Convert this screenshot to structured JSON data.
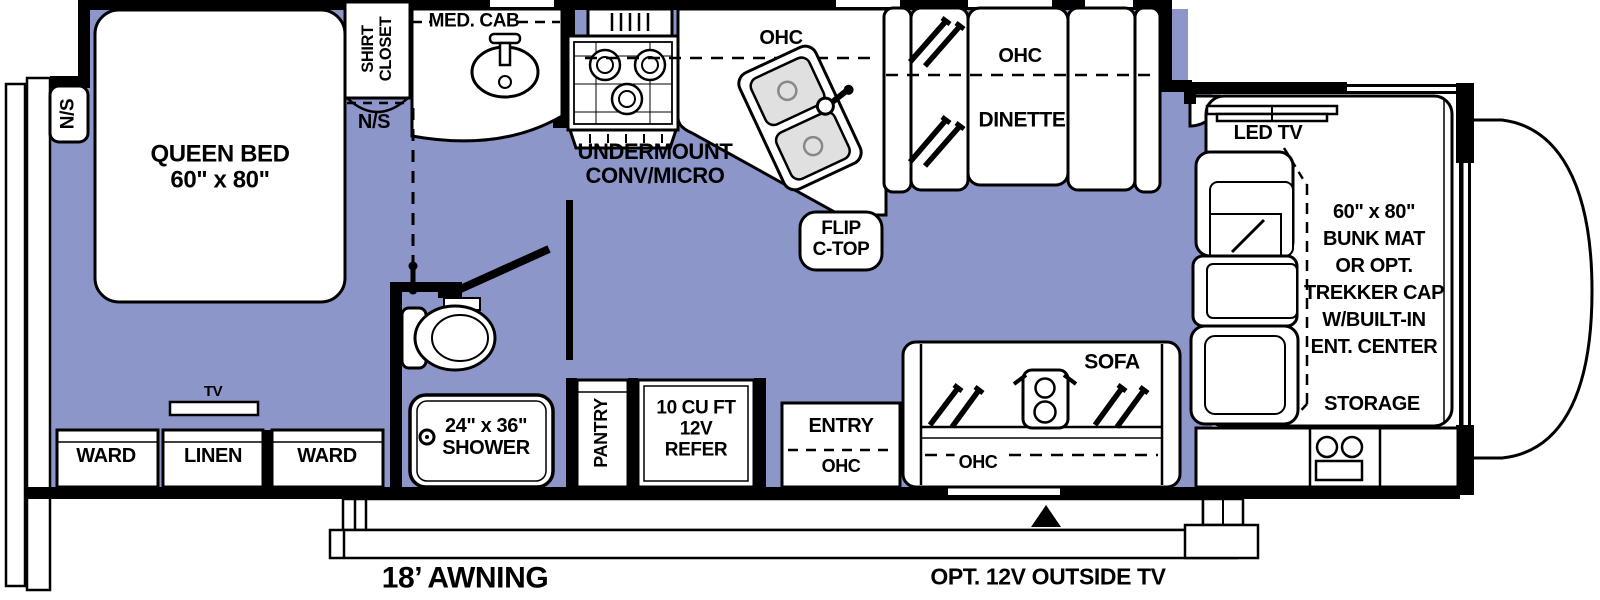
{
  "floorplan": {
    "title": "Class C motorhome floor plan",
    "bedroom": {
      "nightstand_left": "N/S",
      "bed_line1": "QUEEN BED",
      "bed_line2": "60\" x 80\"",
      "shirt_closet_line1": "SHIRT",
      "shirt_closet_line2": "CLOSET",
      "nightstand_right": "N/S",
      "tv": "TV",
      "ward_left": "WARD",
      "linen": "LINEN",
      "ward_right": "WARD"
    },
    "bathroom": {
      "med_cab": "MED. CAB",
      "shower_line1": "24\" x 36\"",
      "shower_line2": "SHOWER"
    },
    "kitchen": {
      "undermount_line1": "UNDERMOUNT",
      "undermount_line2": "CONV/MICRO",
      "ohc": "OHC",
      "flip_line1": "FLIP",
      "flip_line2": "C-TOP",
      "pantry": "PANTRY",
      "refer_line1": "10 CU FT",
      "refer_line2": "12V",
      "refer_line3": "REFER"
    },
    "dinette": {
      "ohc": "OHC",
      "label": "DINETTE"
    },
    "living": {
      "entry": "ENTRY",
      "entry_ohc": "OHC",
      "sofa": "SOFA",
      "sofa_ohc": "OHC"
    },
    "cab": {
      "led_tv": "LED TV",
      "bunk_line1": "60\" x 80\"",
      "bunk_line2": "BUNK MAT",
      "bunk_line3": "OR OPT.",
      "bunk_line4": "TREKKER CAP",
      "bunk_line5": "W/BUILT-IN",
      "bunk_line6": "ENT. CENTER",
      "storage": "STORAGE"
    },
    "exterior": {
      "awning": "18’ AWNING",
      "outside_tv": "OPT. 12V OUTSIDE TV"
    },
    "colors": {
      "floor": "#8D96C8",
      "line": "#000000",
      "fixture_fill": "#FFFFFF",
      "basin_gray": "#E0E0E0"
    }
  }
}
